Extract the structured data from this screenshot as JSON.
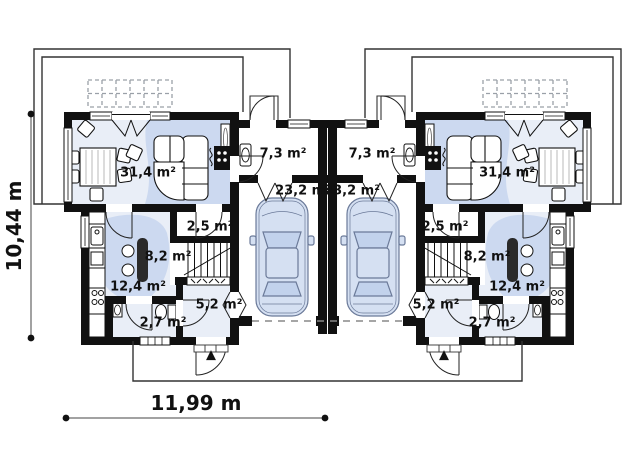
{
  "plan": {
    "type": "floor-plan",
    "description": "Ground floor plan of mirrored twin house with garages",
    "dimensions": {
      "height_label": "10,44 m",
      "width_label": "11,99 m"
    },
    "rooms": [
      {
        "name": "living-dining-room",
        "area": "31,4 m²"
      },
      {
        "name": "entry-hall",
        "area": "7,3 m²"
      },
      {
        "name": "garage",
        "area": "23,2 m²"
      },
      {
        "name": "pantry",
        "area": "2,5 m²"
      },
      {
        "name": "hall-stairs",
        "area": "8,2 m²"
      },
      {
        "name": "kitchen",
        "area": "12,4 m²"
      },
      {
        "name": "vestibule",
        "area": "5,2 m²"
      },
      {
        "name": "wc",
        "area": "2,7 m²"
      }
    ],
    "icons": {
      "entrance_arrow": "▲"
    },
    "colors": {
      "wall": "#111111",
      "room_fill": "#e9eef7",
      "accent_fill": "#ccd9f0",
      "car_fill": "#d5e0f2",
      "car_glass": "#c2d2ec",
      "outline": "#333333"
    }
  }
}
